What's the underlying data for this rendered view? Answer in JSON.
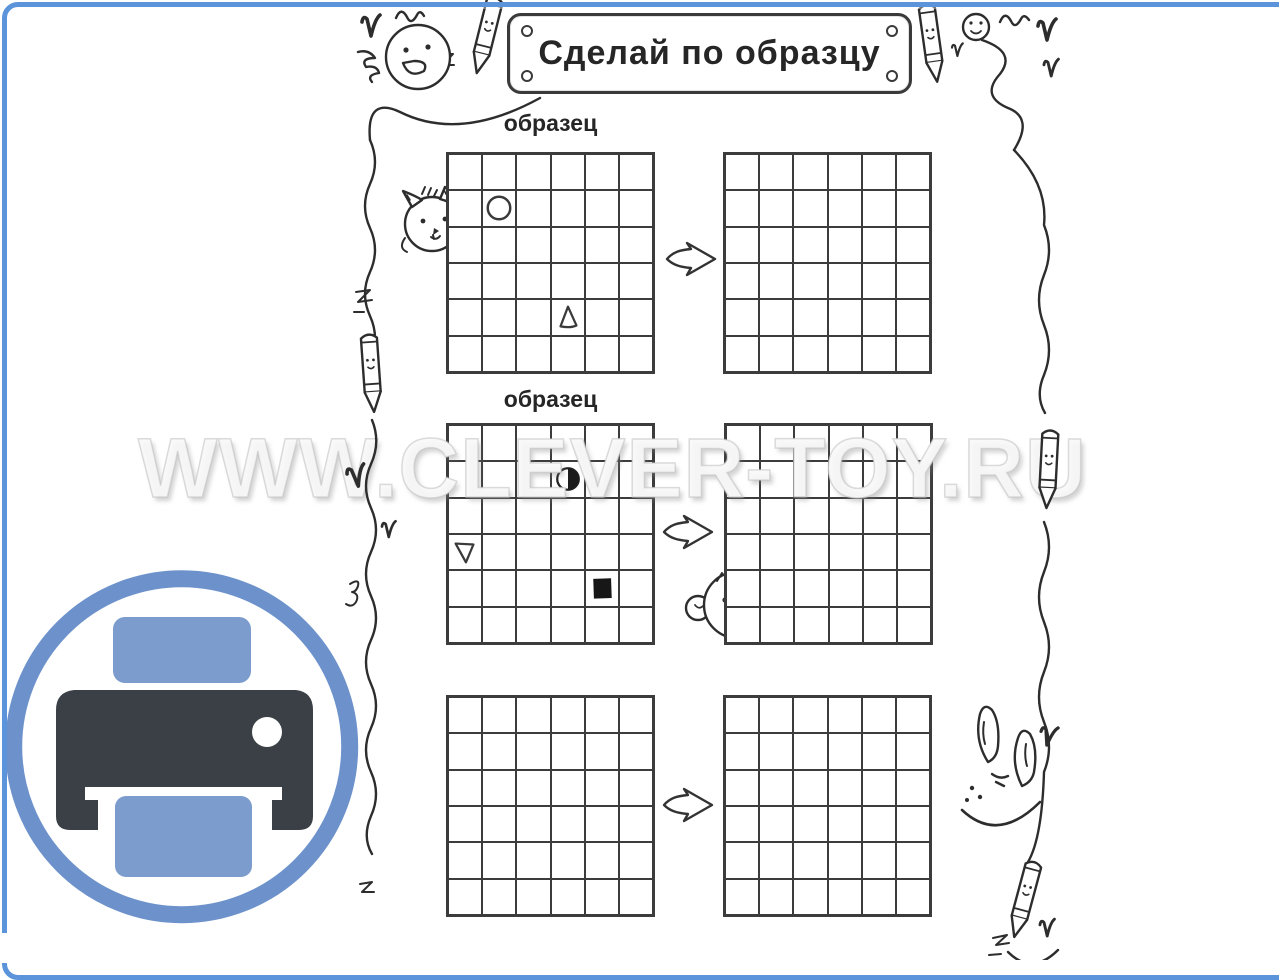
{
  "frame": {
    "border_color": "#5b94da"
  },
  "banner": {
    "title": "Сделай по образцу"
  },
  "watermark": {
    "text": "WWW.CLEVER-TOY.RU"
  },
  "tasks": [
    {
      "sample_label": "образец",
      "grid": {
        "rows": 6,
        "cols": 6
      },
      "shapes": [
        {
          "type": "circle-outline",
          "row": 2,
          "col": 2
        },
        {
          "type": "triangle-up-outline",
          "row": 5,
          "col": 4
        }
      ]
    },
    {
      "sample_label": "образец",
      "grid": {
        "rows": 6,
        "cols": 6
      },
      "shapes": [
        {
          "type": "circle-half-filled",
          "row": 2,
          "col": 4
        },
        {
          "type": "triangle-down-outline",
          "row": 4,
          "col": 1
        },
        {
          "type": "square-filled",
          "row": 5,
          "col": 5
        }
      ]
    },
    {
      "sample_label": "",
      "grid": {
        "rows": 6,
        "cols": 6
      },
      "shapes": []
    }
  ],
  "print_button": {
    "icon": "printer-icon",
    "ring_color": "#6d92cb",
    "printer_color": "#3b4046",
    "paper_color": "#7b9ccd"
  },
  "icons": {
    "printer-icon": "printer shape",
    "arrow-right-icon": "⇒",
    "heart-icon": "♥",
    "smiley-icon": "☺",
    "pencil-icon": "✏",
    "cat-icon": "cat doodle",
    "bear-icon": "bear doodle",
    "rabbit-icon": "rabbit doodle",
    "wavy-line": "~"
  }
}
